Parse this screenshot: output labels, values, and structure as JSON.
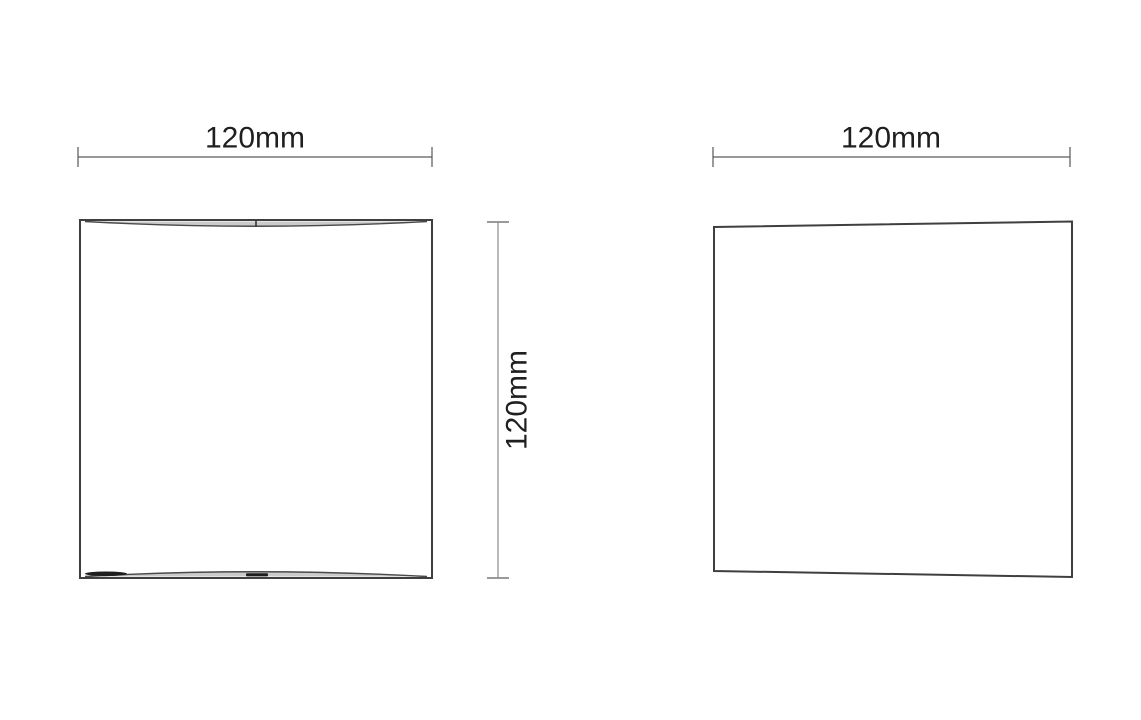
{
  "document": {
    "background": "#ffffff",
    "content": "technical dimension drawing, two orthographic views of a square wall luminaire"
  },
  "views": {
    "front": {
      "width_dimension": {
        "label": "120mm",
        "value": 120,
        "unit": "mm"
      },
      "height_dimension": {
        "label": "120mm",
        "value": 120,
        "unit": "mm"
      }
    },
    "side": {
      "width_dimension": {
        "label": "120mm",
        "value": 120,
        "unit": "mm"
      }
    }
  },
  "colors": {
    "outline": "#3f3f3f",
    "dimension_line": "#5a5a5a",
    "dimension_tick": "#9a9a9a",
    "label_text": "#1f1f1f",
    "aperture_shade": "#a0a0a0",
    "background": "#ffffff"
  }
}
